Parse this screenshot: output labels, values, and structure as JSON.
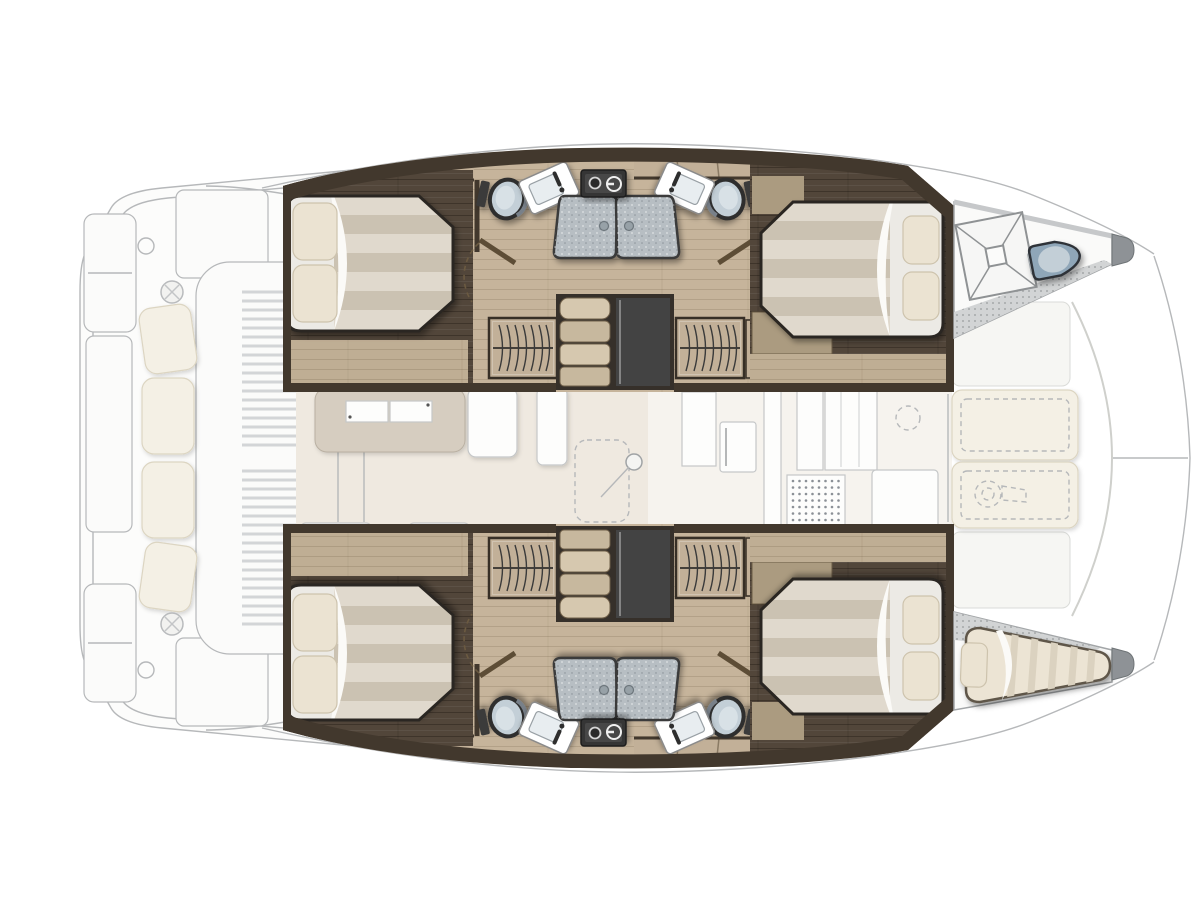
{
  "image": {
    "type": "catamaran-interior-floorplan",
    "orientation": "bow-right-stern-left",
    "visible_text": "",
    "style": "top-down naval architecture layout; lower hulls highlighted in color, main deck shown faded"
  },
  "palette": {
    "wall": "#42382d",
    "floor": "#c6b49b",
    "floor2": "#bfae94",
    "wood2": "#c2b098",
    "wood3": "#ab9b80",
    "platform": "#52463a",
    "bed-base": "#e9e8e4",
    "bed-stripe-a": "#e0d9cd",
    "bed-stripe-b": "#cbc2b2",
    "sheet": "#eceae5",
    "pillow": "#ebe3d2",
    "pillow-edge": "#cdc3ad",
    "shower": "#b7bec3",
    "shower-frame": "#3b3b3b",
    "washer": "#353535",
    "void": "#434343",
    "toilet-ring": "#2f2f2f",
    "toilet-lid": "#c3cfd7",
    "sea-toilet": "#8fa6b8",
    "step-a": "#d6c8af",
    "step-b": "#c7b89e",
    "faint": "#b6b8ba",
    "faint-fill": "#fbfbfa",
    "saloon-floor": "#efe9e0",
    "table": "#d6cdc0",
    "deck-gray": "#d2d4d5",
    "tip-gray": "#8e9296",
    "cushion": "#f4f0e5",
    "outline-dark": "#2c2720"
  },
  "features": {
    "port_hull": [
      "aft-double-cabin",
      "aft-bathroom-toilet",
      "aft-bathroom-sink",
      "shower-stall-pair",
      "washer-unit",
      "hanging-wardrobe-pair",
      "companionway-stairs",
      "forward-bathroom-sink",
      "forward-bathroom-toilet",
      "forward-double-cabin",
      "forepeak-deck-hatch",
      "forepeak-sea-toilet"
    ],
    "starboard_hull": [
      "aft-double-cabin",
      "aft-bathroom-toilet",
      "aft-bathroom-sink",
      "shower-stall-pair",
      "washer-unit",
      "hanging-wardrobe-pair",
      "companionway-stairs",
      "forward-bathroom-sink",
      "forward-bathroom-toilet",
      "forward-double-cabin",
      "forepeak-single-berth"
    ],
    "main_deck_faded": [
      "stern-platforms",
      "tender-storage",
      "cockpit-bench-cushions",
      "cockpit-winches",
      "slatted-aft-deck",
      "saloon-table",
      "saloon-sofa",
      "galley-units",
      "cooktop-vent-grid",
      "mast-foot",
      "foredeck-sunpads",
      "foredeck-winch",
      "bowsprit-lines"
    ]
  },
  "counts": {
    "double_beds": 4,
    "single_berths": 1,
    "shower_stalls": 4,
    "toilets": 5,
    "sinks": 4,
    "wardrobes": 4,
    "washer_units": 2,
    "stair_flights": 2
  }
}
